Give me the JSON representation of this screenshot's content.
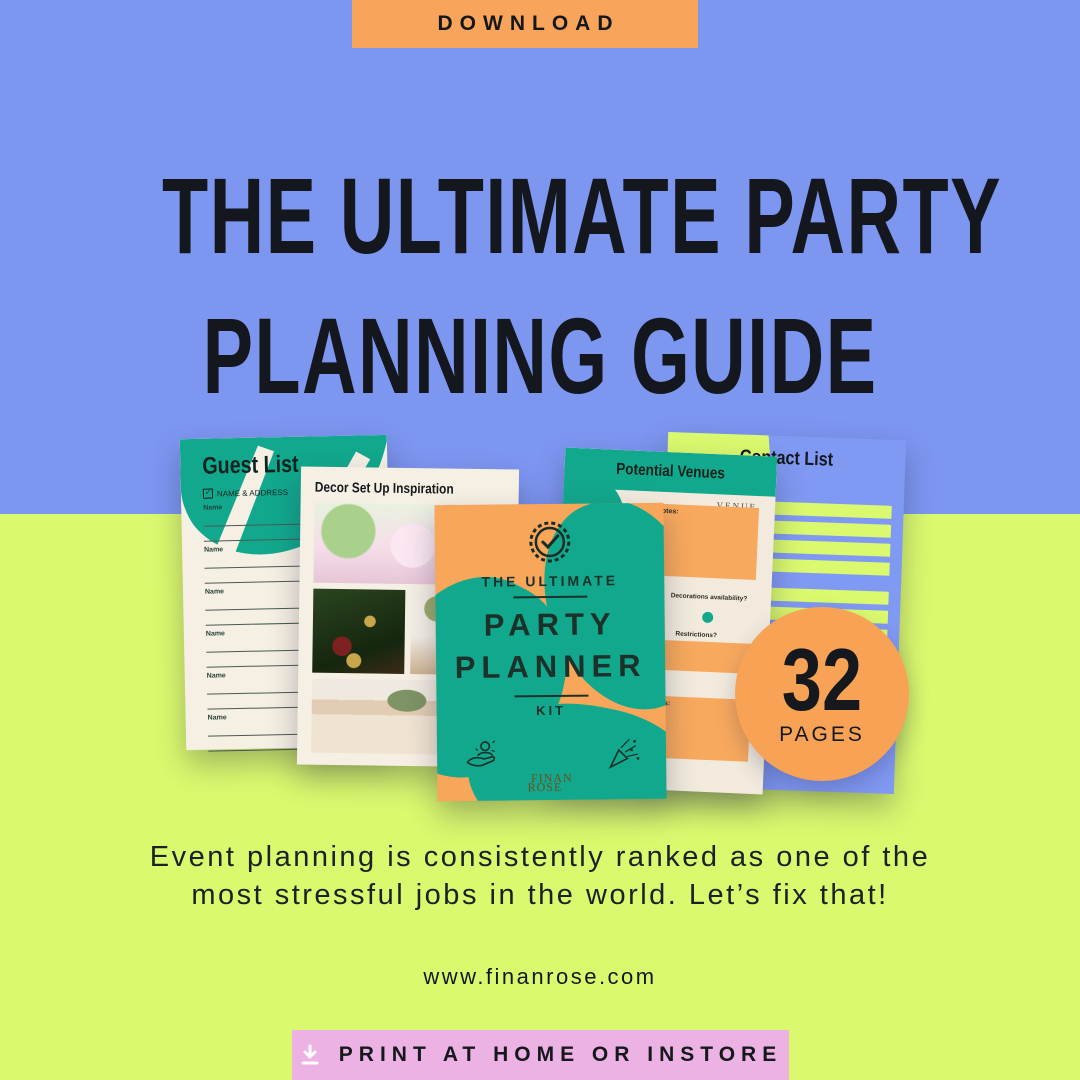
{
  "colors": {
    "background_top": "#7D96F0",
    "background_bottom": "#DAF96E",
    "accent_orange": "#F7A65A",
    "accent_teal": "#12A88D",
    "accent_pink": "#ECB2E3",
    "page_cream": "#F6EFE3",
    "text": "#15181D"
  },
  "download_button": {
    "label": "DOWNLOAD"
  },
  "headline": {
    "line1": "THE ULTIMATE PARTY",
    "line2": "PLANNING GUIDE"
  },
  "collage": {
    "guest_list": {
      "title": "Guest List",
      "meta": "NAME & ADDRESS",
      "row_label": "Name",
      "row_count": 6
    },
    "decor": {
      "title": "Decor Set Up Inspiration"
    },
    "cover": {
      "eyebrow": "THE ULTIMATE",
      "title_line1": "PARTY",
      "title_line2": "PLANNER",
      "subtitle": "KIT",
      "brand_line1": "FINAN",
      "brand_line2": "ROSE"
    },
    "venues": {
      "title": "Potential Venues",
      "section_label": "VENUE",
      "notes_label": "Notes:",
      "question1": "Parking/ Transportation?",
      "question2": "Decorations availability?",
      "question3": "Notes?",
      "question4": "Restrictions?"
    },
    "contact_list": {
      "title": "Contact List",
      "company_label": "Company",
      "phone_label": "Phone",
      "group_count": 3
    },
    "badge": {
      "number": "32",
      "label": "PAGES"
    }
  },
  "tagline": {
    "line1": "Event planning is consistently ranked as one of the",
    "line2": "most stressful jobs in the world. Let’s fix that!"
  },
  "website": "www.finanrose.com",
  "print_button": {
    "label": "PRINT AT HOME OR INSTORE"
  },
  "icons": {
    "print_button": "download-arrow-icon",
    "cover_top": "seal-check-icon",
    "cover_left": "hand-person-icon",
    "cover_right": "party-popper-icon",
    "guest_meta": "checkbox-icon"
  }
}
